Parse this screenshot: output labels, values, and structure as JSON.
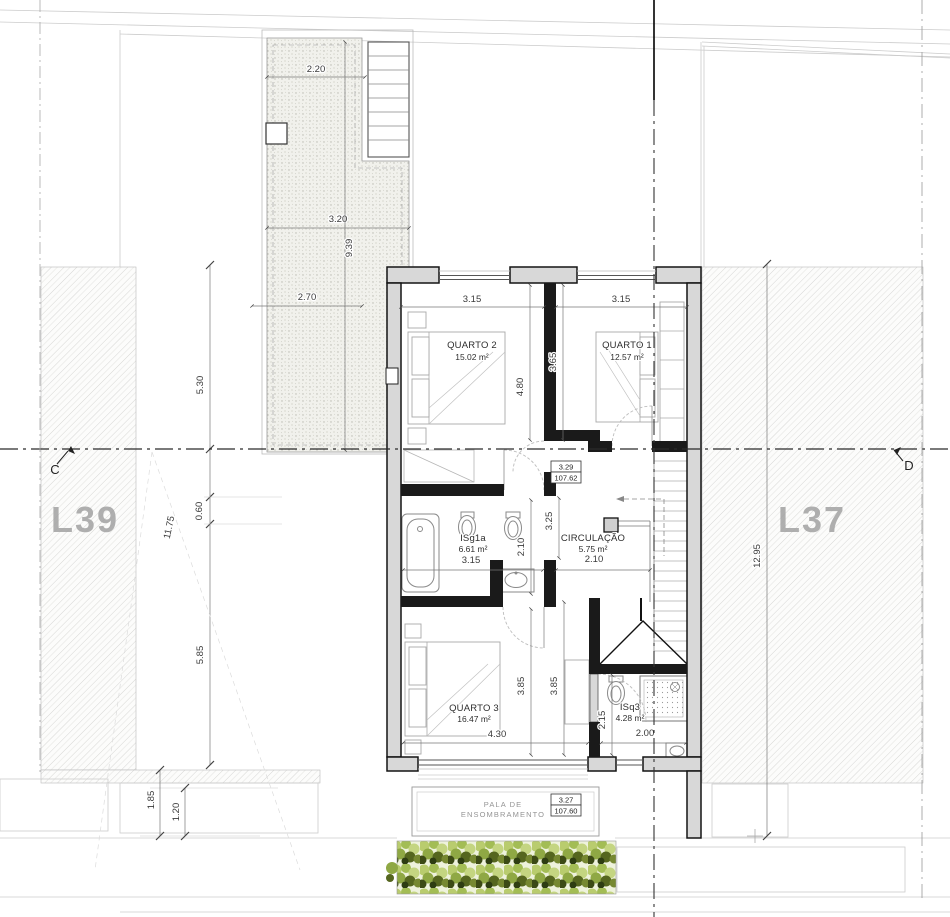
{
  "labels": {
    "plot_left": "L39",
    "plot_right": "L37",
    "section_left": "C",
    "section_right": "D"
  },
  "rooms": {
    "quarto2": {
      "name": "QUARTO 2",
      "area": "15.02 m²"
    },
    "quarto1": {
      "name": "QUARTO 1",
      "area": "12.57 m²"
    },
    "isg1a": {
      "name": "ISg1a",
      "area": "6.61 m²"
    },
    "circulacao": {
      "name": "CIRCULAÇÃO",
      "area": "5.75 m²"
    },
    "quarto3": {
      "name": "QUARTO 3",
      "area": "16.47 m²"
    },
    "isq3": {
      "name": "ISq3",
      "area": "4.28 m²"
    }
  },
  "levels": {
    "upper": {
      "height": "3.29",
      "elevation": "107.62"
    },
    "canopy": {
      "height": "3.27",
      "elevation": "107.60"
    }
  },
  "canopy": {
    "line1": "PALA DE",
    "line2": "ENSOMBRAMENTO"
  },
  "dims": {
    "terrace_top": "2.20",
    "terrace_mid": "3.20",
    "terrace_len": "9.39",
    "terrace_low": "2.70",
    "left_upper": "5.30",
    "left_mid": "0.60",
    "left_lower": "5.85",
    "left_total": "11.75",
    "left_b1": "1.85",
    "left_b2": "1.20",
    "right_total": "12.95",
    "q2_w": "3.15",
    "q1_w": "3.15",
    "q2_h": "4.80",
    "q1_h": "3.65",
    "hall_h": "3.25",
    "isg_w": "3.15",
    "isg_h": "2.10",
    "hall_w": "2.10",
    "q3_ha": "3.85",
    "q3_hb": "3.85",
    "q3_w": "4.30",
    "isq3_h": "2.15",
    "isq3_w": "2.00"
  }
}
